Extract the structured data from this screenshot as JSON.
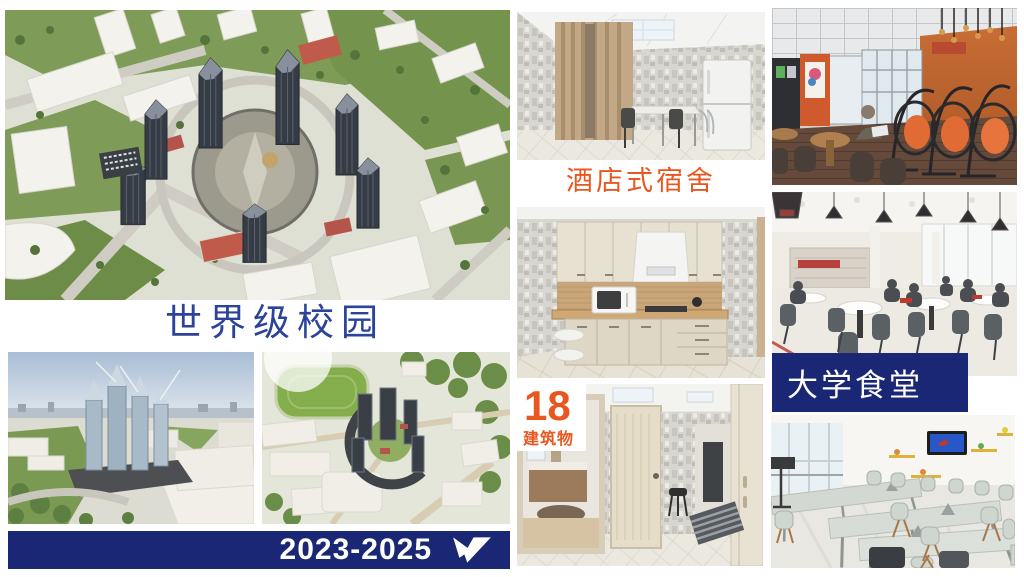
{
  "colors": {
    "navy": "#1a2775",
    "orange": "#e9571f",
    "heading_blue": "#2b4399",
    "banner_text": "#ffffff"
  },
  "left_column": {
    "caption": "世界级校园",
    "banner": {
      "years": "2023-2025",
      "logo_icon": "wing-check-logo-icon"
    }
  },
  "middle_column": {
    "dorm_caption": "酒店式宿舍",
    "buildings": {
      "count": "18",
      "label": "建筑物"
    }
  },
  "right_column": {
    "canteen_caption": "大学食堂"
  }
}
